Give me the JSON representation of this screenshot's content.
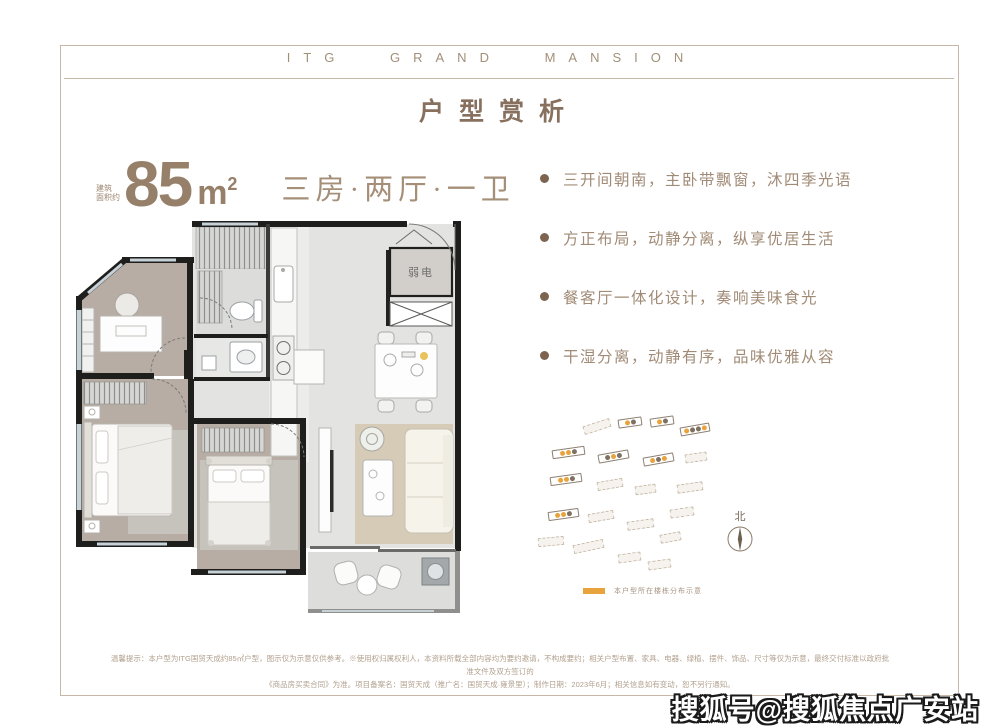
{
  "header": {
    "brand": "ITG GRAND MANSION",
    "title": "户型赏析"
  },
  "unit": {
    "note_line1": "建筑",
    "note_line2": "面积约",
    "area_value": "85",
    "area_unit": "m",
    "area_exp": "2",
    "rooms": "三房·两厅·一卫"
  },
  "features": [
    "三开间朝南，主卧带飘窗，沐四季光语",
    "方正布局，动静分离，纵享优居生活",
    "餐客厅一体化设计，奏响美味食光",
    "干湿分离，动静有序，品味优雅从容"
  ],
  "floorplan": {
    "weak_power_label": "弱电"
  },
  "siteplan": {
    "north_label": "北",
    "legend_text": "本户型所在楼栋分布示意",
    "highlight_color": "#E8A33C",
    "dot_dark_color": "#7E7062",
    "buildings": [
      {
        "x": 95,
        "y": 20,
        "w": 24,
        "rot": -8,
        "type": "solid",
        "dots": [
          "y",
          "d"
        ]
      },
      {
        "x": 127,
        "y": 19,
        "w": 24,
        "rot": -8,
        "type": "solid",
        "dots": [
          "y",
          "d"
        ]
      },
      {
        "x": 157,
        "y": 27,
        "w": 30,
        "rot": -10,
        "type": "solid",
        "dots": [
          "y",
          "d",
          "d",
          "y"
        ]
      },
      {
        "x": 60,
        "y": 24,
        "w": 28,
        "rot": -18,
        "type": "dotted",
        "dots": []
      },
      {
        "x": 29,
        "y": 50,
        "w": 33,
        "rot": -8,
        "type": "solid",
        "dots": [
          "y",
          "y",
          "d"
        ]
      },
      {
        "x": 75,
        "y": 54,
        "w": 31,
        "rot": -10,
        "type": "solid",
        "dots": [
          "d",
          "y",
          "d"
        ]
      },
      {
        "x": 120,
        "y": 57,
        "w": 31,
        "rot": -10,
        "type": "solid",
        "dots": [
          "y",
          "d",
          "y"
        ]
      },
      {
        "x": 162,
        "y": 55,
        "w": 22,
        "rot": -8,
        "type": "dotted",
        "dots": []
      },
      {
        "x": 27,
        "y": 77,
        "w": 32,
        "rot": -8,
        "type": "solid",
        "dots": [
          "y",
          "y",
          "d"
        ]
      },
      {
        "x": 74,
        "y": 82,
        "w": 26,
        "rot": -10,
        "type": "dotted",
        "dots": []
      },
      {
        "x": 112,
        "y": 87,
        "w": 21,
        "rot": -8,
        "type": "dotted",
        "dots": []
      },
      {
        "x": 154,
        "y": 85,
        "w": 26,
        "rot": -8,
        "type": "dotted",
        "dots": []
      },
      {
        "x": 25,
        "y": 112,
        "w": 31,
        "rot": -8,
        "type": "solid",
        "dots": [
          "y",
          "y",
          "d"
        ]
      },
      {
        "x": 65,
        "y": 114,
        "w": 26,
        "rot": -10,
        "type": "dotted",
        "dots": []
      },
      {
        "x": 104,
        "y": 122,
        "w": 27,
        "rot": -8,
        "type": "dotted",
        "dots": []
      },
      {
        "x": 147,
        "y": 110,
        "w": 24,
        "rot": -8,
        "type": "dotted",
        "dots": []
      },
      {
        "x": 15,
        "y": 139,
        "w": 26,
        "rot": -5,
        "type": "dotted",
        "dots": []
      },
      {
        "x": 50,
        "y": 144,
        "w": 31,
        "rot": -12,
        "type": "dotted",
        "dots": []
      },
      {
        "x": 95,
        "y": 155,
        "w": 23,
        "rot": -8,
        "type": "dotted",
        "dots": []
      },
      {
        "x": 137,
        "y": 135,
        "w": 21,
        "rot": -10,
        "type": "dotted",
        "dots": []
      },
      {
        "x": 125,
        "y": 162,
        "w": 23,
        "rot": -8,
        "type": "dotted",
        "dots": []
      }
    ]
  },
  "footer": {
    "line1": "温馨提示：本户型为ITG国贸天成约85㎡户型，图示仅为示意仅供参考。※使用权归属权利人，本资料所载全部内容均为要约邀请，不构成要约；相关户型布置、家具、电器、绿植、摆件、饰品、尺寸等仅为示意，最终交付标准以政府批准文件及双方签订的",
    "line2": "《商品房买卖合同》为准。项目备案名：国贸天成（推广名：国贸天成·雍景里）；制作日期：2023年6月；相关信息如有变动，恕不另行通知。"
  },
  "watermark": "搜狐号@搜狐焦点广安站"
}
